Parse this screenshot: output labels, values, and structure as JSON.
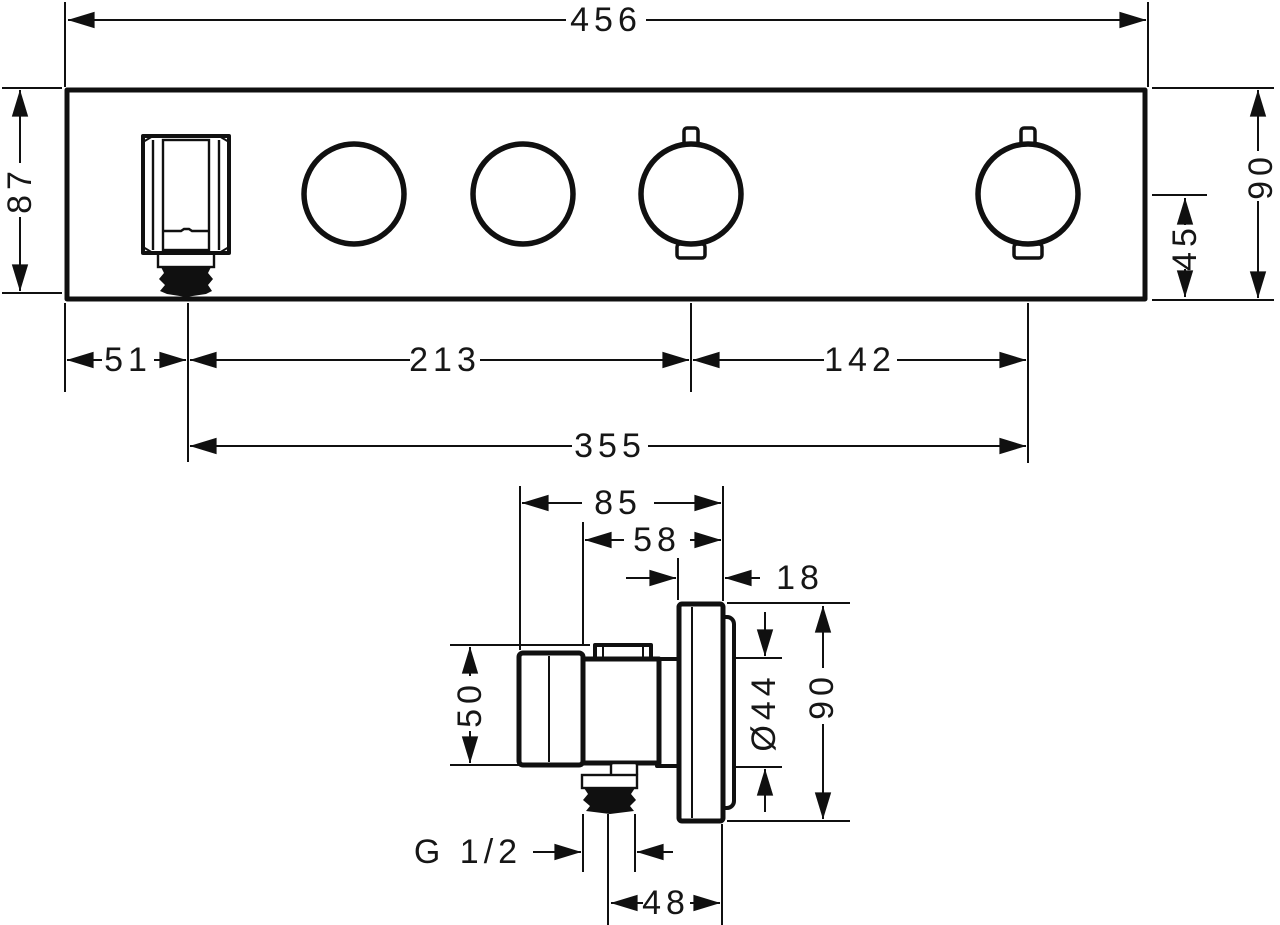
{
  "page": {
    "background": "#ffffff",
    "line_color": "#101010",
    "description": "Technical dimension drawing of a thermostat shower module: front view with valve outlet and four knobs, plus side profile view of outlet valve with escutcheon plate"
  },
  "top_view": {
    "dim_width": "456",
    "dim_height_face": "87",
    "dim_height_total": "90",
    "dim_bottom_offset": "45",
    "dim_left_offset": "51",
    "dim_span_mid": "213",
    "dim_span_right": "142",
    "dim_span_total": "355"
  },
  "side_view": {
    "dim_depth_total": "85",
    "dim_depth_front": "58",
    "dim_plate_depth": "18",
    "dim_body_height": "50",
    "dim_flange_diameter": "Ø44",
    "dim_plate_height": "90",
    "thread_label": "G 1/2",
    "dim_outlet_offset": "48"
  }
}
